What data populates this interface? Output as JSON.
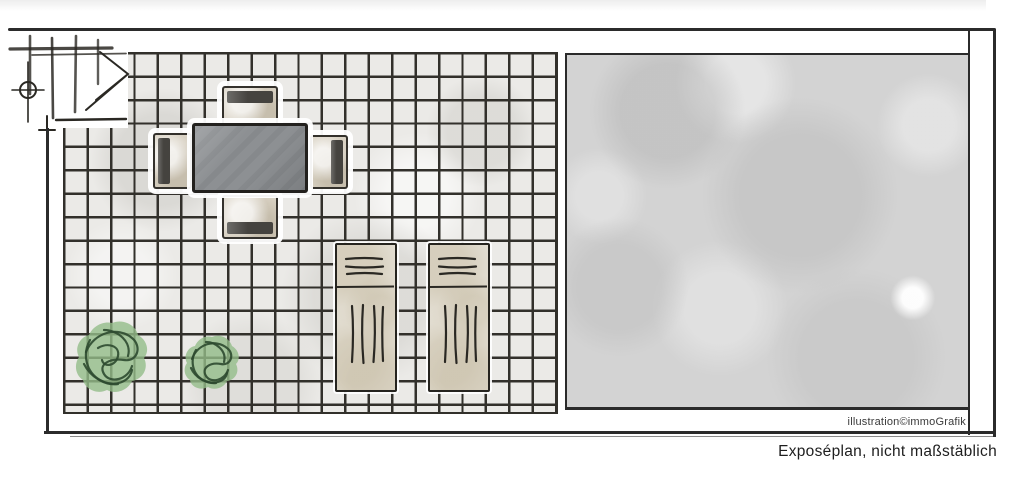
{
  "caption": {
    "credit": "illustration©immoGrafik",
    "disclaimer": "Exposéplan, nicht maßstäblich"
  },
  "plan": {
    "counts": {
      "tables": 1,
      "chairs": 4,
      "loungers": 2,
      "plants": 2
    },
    "colors": {
      "ink": "#2b2b2b",
      "grid-line": "#32302b",
      "tile": "#ebeae7",
      "gravel": "#d3d3d3",
      "table": "#8d9093",
      "chair-seat": "#d9d2c4",
      "chair-back": "#45433f",
      "lounger": "#e9e5dc",
      "plant-fill": "#93bd8a",
      "plant-stroke": "#2e4a30",
      "caption-text": "#1e1e1e",
      "credit-text": "#3a3a3a"
    }
  }
}
